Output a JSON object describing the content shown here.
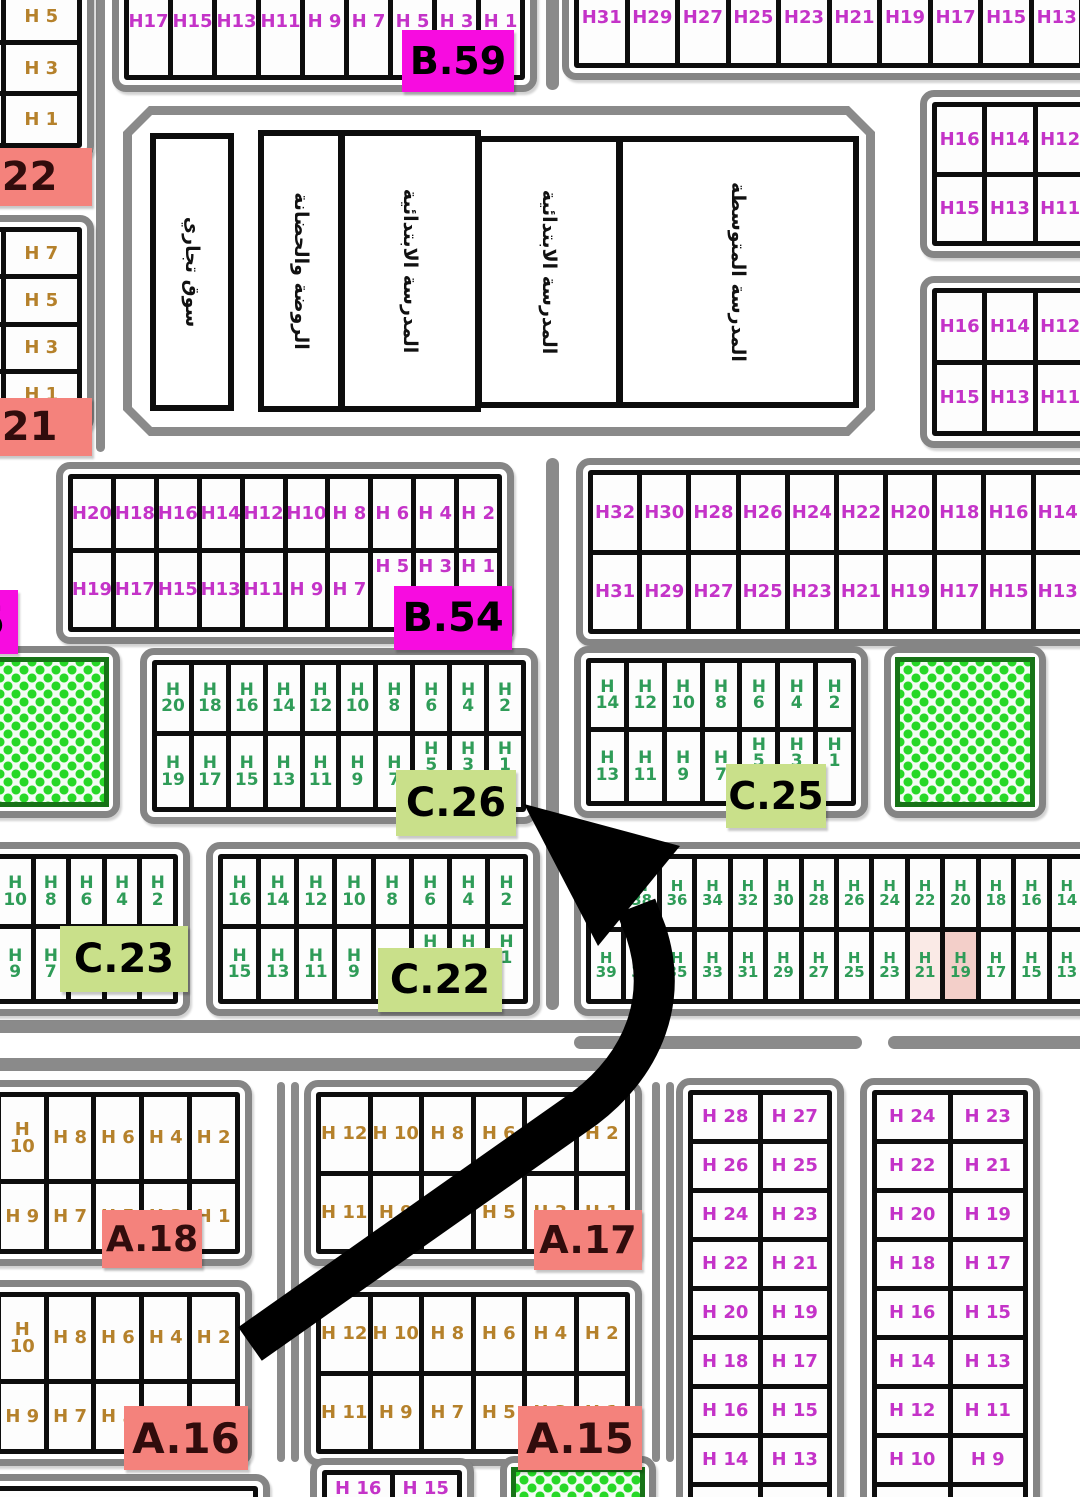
{
  "colors": {
    "canvas_bg": "#ffffff",
    "road": "#8a8a8a",
    "block_border": "#858585",
    "cell_line": "#0d0d0d",
    "cell_bg": "#fdfdfd",
    "magenta_text": "#c433c8",
    "brown_text": "#b5812b",
    "green_text": "#2f9c58",
    "magenta_label_bg": "#f70ce0",
    "salmon_label_bg": "#f4827c",
    "lime_label_bg": "#c9e08a",
    "salmon_label_text": "#310c0c",
    "park_dot": "#27d827",
    "park_border": "#177317",
    "highlight_strong": "#f3cfc9",
    "highlight_soft": "#faeae6",
    "arrow": "#000000"
  },
  "roads": [
    {
      "x": 96,
      "y": -10,
      "w": 9,
      "h": 462
    },
    {
      "x": 546,
      "y": -12,
      "w": 13,
      "h": 102
    },
    {
      "x": 546,
      "y": 458,
      "w": 13,
      "h": 552
    },
    {
      "x": -20,
      "y": 1020,
      "w": 655,
      "h": 13
    },
    {
      "x": -20,
      "y": 1058,
      "w": 655,
      "h": 13
    },
    {
      "x": 574,
      "y": 1036,
      "w": 288,
      "h": 13
    },
    {
      "x": 888,
      "y": 1036,
      "w": 202,
      "h": 13
    },
    {
      "x": 277,
      "y": 1082,
      "w": 8,
      "h": 380
    },
    {
      "x": 291,
      "y": 1082,
      "w": 8,
      "h": 380
    },
    {
      "x": 652,
      "y": 1082,
      "w": 8,
      "h": 380
    },
    {
      "x": 666,
      "y": 1082,
      "w": 8,
      "h": 380
    }
  ],
  "school": {
    "outer": {
      "x": 123,
      "y": 106,
      "w": 752,
      "h": 330
    },
    "rooms": [
      {
        "x": 150,
        "y": 133,
        "w": 84,
        "h": 278,
        "text": "سوق تجاري"
      },
      {
        "x": 258,
        "y": 130,
        "w": 86,
        "h": 282,
        "text": "الروضة والحضانة"
      },
      {
        "x": 339,
        "y": 130,
        "w": 142,
        "h": 282,
        "text": "المدرسة الابتدائية"
      },
      {
        "x": 476,
        "y": 136,
        "w": 146,
        "h": 272,
        "text": "المدرسة الابتدائية"
      },
      {
        "x": 617,
        "y": 136,
        "w": 242,
        "h": 272,
        "text": "المدرسة المتوسطة"
      }
    ]
  },
  "blocks": [
    {
      "id": "strip-b22",
      "x": -88,
      "y": -58,
      "w": 182,
      "h": 218,
      "cols": 2,
      "fs": 18,
      "tc": "brown",
      "rows": [
        [
          "",
          ""
        ],
        [
          "",
          "H 5"
        ],
        [
          "",
          "H 3"
        ],
        [
          "",
          "H 1"
        ]
      ]
    },
    {
      "id": "strip-b21",
      "x": -88,
      "y": 215,
      "w": 182,
      "h": 218,
      "cols": 2,
      "fs": 18,
      "tc": "brown",
      "rows": [
        [
          "",
          "H 7"
        ],
        [
          "",
          "H 5"
        ],
        [
          "",
          "H 3"
        ],
        [
          "",
          "H 1"
        ]
      ]
    },
    {
      "id": "row-b59",
      "x": 112,
      "y": -48,
      "w": 425,
      "h": 140,
      "cols": 9,
      "fs": 18,
      "tc": "magenta",
      "rows": [
        [
          "H17",
          "H15",
          "H13",
          "H11",
          "H 9",
          "H 7",
          "H 5",
          "H 3",
          "H 1"
        ]
      ]
    },
    {
      "id": "row-top-right",
      "x": 562,
      "y": -45,
      "w": 585,
      "h": 125,
      "cols": 11,
      "fs": 18,
      "tc": "magenta",
      "rows": [
        [
          "H31",
          "H29",
          "H27",
          "H25",
          "H23",
          "H21",
          "H19",
          "H17",
          "H15",
          "H13",
          "H11"
        ]
      ]
    },
    {
      "id": "grid-ne-1",
      "x": 920,
      "y": 90,
      "w": 230,
      "h": 168,
      "cols": 4,
      "fs": 18,
      "tc": "magenta",
      "rows": [
        [
          "H16",
          "H14",
          "H12",
          ""
        ],
        [
          "H15",
          "H13",
          "H11",
          ""
        ]
      ]
    },
    {
      "id": "grid-ne-2",
      "x": 920,
      "y": 276,
      "w": 230,
      "h": 172,
      "cols": 4,
      "fs": 18,
      "tc": "magenta",
      "rows": [
        [
          "H16",
          "H14",
          "H12",
          ""
        ],
        [
          "H15",
          "H13",
          "H11",
          ""
        ]
      ]
    },
    {
      "id": "block-b54",
      "x": 56,
      "y": 462,
      "w": 458,
      "h": 182,
      "cols": 10,
      "fs": 18,
      "tc": "magenta",
      "rows": [
        [
          "H20",
          "H18",
          "H16",
          "H14",
          "H12",
          "H10",
          "H 8",
          "H 6",
          "H 4",
          "H 2"
        ],
        [
          "H19",
          "H17",
          "H15",
          "H13",
          "H11",
          "H 9",
          "H 7",
          "^H 5",
          "^H 3",
          "^H 1"
        ]
      ]
    },
    {
      "id": "block-mid-right",
      "x": 576,
      "y": 458,
      "w": 570,
      "h": 188,
      "cols": 11,
      "fs": 18,
      "tc": "magenta",
      "rows": [
        [
          "H32",
          "H30",
          "H28",
          "H26",
          "H24",
          "H22",
          "H20",
          "H18",
          "H16",
          "H14",
          "H12"
        ],
        [
          "H31",
          "H29",
          "H27",
          "H25",
          "H23",
          "H21",
          "H19",
          "H17",
          "H15",
          "H13",
          "H11"
        ]
      ]
    },
    {
      "id": "block-c26",
      "x": 140,
      "y": 648,
      "w": 398,
      "h": 176,
      "cols": 10,
      "fs": 17,
      "tc": "green",
      "rows": [
        [
          "H|20",
          "H|18",
          "H|16",
          "H|14",
          "H|12",
          "H|10",
          "H|8",
          "H|6",
          "H|4",
          "H|2"
        ],
        [
          "H|19",
          "H|17",
          "H|15",
          "H|13",
          "H|11",
          "H|9",
          "H|7",
          "^H|5",
          "^H|3",
          "^H|1"
        ]
      ]
    },
    {
      "id": "block-c25",
      "x": 574,
      "y": 646,
      "w": 294,
      "h": 172,
      "cols": 7,
      "fs": 17,
      "tc": "green",
      "rows": [
        [
          "H|14",
          "H|12",
          "H|10",
          "H|8",
          "H|6",
          "H|4",
          "H|2"
        ],
        [
          "H|13",
          "H|11",
          "H|9",
          "H|7",
          "^H|5",
          "^H|3",
          "^H|1"
        ]
      ]
    },
    {
      "id": "block-c23",
      "x": -124,
      "y": 842,
      "w": 314,
      "h": 174,
      "cols": 8,
      "fs": 17,
      "tc": "green",
      "rows": [
        [
          "",
          "",
          "",
          "H|10",
          "H|8",
          "H|6",
          "H|4",
          "H|2"
        ],
        [
          "",
          "",
          "",
          "H|9",
          "H|7",
          "^H|5",
          "^H|3",
          "^H|1"
        ]
      ]
    },
    {
      "id": "block-c22",
      "x": 206,
      "y": 842,
      "w": 334,
      "h": 174,
      "cols": 8,
      "fs": 17,
      "tc": "green",
      "rows": [
        [
          "H|16",
          "H|14",
          "H|12",
          "H|10",
          "H|8",
          "H|6",
          "H|4",
          "H|2"
        ],
        [
          "H|15",
          "H|13",
          "H|11",
          "H|9",
          "H|7",
          "^H|5",
          "^H|3",
          "^H|1"
        ]
      ]
    },
    {
      "id": "block-c-east",
      "x": 574,
      "y": 842,
      "w": 525,
      "h": 174,
      "cols": 14,
      "fs": 15,
      "tc": "green",
      "rows": [
        [
          "H|40",
          "H|38",
          "H|36",
          "H|34",
          "H|32",
          "H|30",
          "H|28",
          "H|26",
          "H|24",
          "H|22",
          "H|20",
          "H|18",
          "H|16",
          "H|14"
        ],
        [
          "H|39",
          "H|37",
          "H|35",
          "H|33",
          "H|31",
          "H|29",
          "H|27",
          "H|25",
          "H|23",
          "~H|21",
          "!H|19",
          "H|17",
          "H|15",
          "H|13"
        ]
      ]
    },
    {
      "id": "block-a18",
      "x": -64,
      "y": 1080,
      "w": 316,
      "h": 186,
      "cols": 6,
      "fs": 18,
      "tc": "brown",
      "rows": [
        [
          "",
          "H 10",
          "H 8",
          "H 6",
          "H 4",
          "H 2"
        ],
        [
          "",
          "H 9",
          "H 7",
          "H 5",
          "H 3",
          "H 1"
        ]
      ]
    },
    {
      "id": "block-a17",
      "x": 304,
      "y": 1080,
      "w": 338,
      "h": 186,
      "cols": 6,
      "fs": 18,
      "tc": "brown",
      "rows": [
        [
          "H 12",
          "H 10",
          "H 8",
          "H 6",
          "H 4",
          "H 2"
        ],
        [
          "H 11",
          "H 9",
          "H 7",
          "H 5",
          "H 3",
          "H 1"
        ]
      ]
    },
    {
      "id": "block-a16",
      "x": -64,
      "y": 1280,
      "w": 316,
      "h": 186,
      "cols": 6,
      "fs": 18,
      "tc": "brown",
      "rows": [
        [
          "",
          "H 10",
          "H 8",
          "H 6",
          "H 4",
          "H 2"
        ],
        [
          "",
          "H 9",
          "H 7",
          "H 5",
          "H 3",
          "H 1"
        ]
      ]
    },
    {
      "id": "block-a15",
      "x": 304,
      "y": 1280,
      "w": 338,
      "h": 186,
      "cols": 6,
      "fs": 18,
      "tc": "brown",
      "rows": [
        [
          "H 12",
          "H 10",
          "H 8",
          "H 6",
          "H 4",
          "H 2"
        ],
        [
          "H 11",
          "H 9",
          "H 7",
          "H 5",
          "H 3",
          "H 1"
        ]
      ]
    },
    {
      "id": "grid-se-1",
      "x": 676,
      "y": 1078,
      "w": 168,
      "h": 470,
      "cols": 2,
      "fs": 18,
      "tc": "magenta",
      "rows": [
        [
          "H 28",
          "H 27"
        ],
        [
          "H 26",
          "H 25"
        ],
        [
          "H 24",
          "H 23"
        ],
        [
          "H 22",
          "H 21"
        ],
        [
          "H 20",
          "H 19"
        ],
        [
          "H 18",
          "H 17"
        ],
        [
          "H 16",
          "H 15"
        ],
        [
          "H 14",
          "H 13"
        ],
        [
          "H 12",
          "H 11"
        ]
      ]
    },
    {
      "id": "grid-se-2",
      "x": 860,
      "y": 1078,
      "w": 180,
      "h": 470,
      "cols": 2,
      "fs": 18,
      "tc": "magenta",
      "rows": [
        [
          "H 24",
          "H 23"
        ],
        [
          "H 22",
          "H 21"
        ],
        [
          "H 20",
          "H 19"
        ],
        [
          "H 18",
          "H 17"
        ],
        [
          "H 16",
          "H 15"
        ],
        [
          "H 14",
          "H 13"
        ],
        [
          "H 12",
          "H 11"
        ],
        [
          "H 10",
          "H 9"
        ],
        [
          "H 8",
          "H 7"
        ]
      ]
    },
    {
      "id": "block-h16-h15",
      "x": 310,
      "y": 1458,
      "w": 164,
      "h": 84,
      "cols": 2,
      "fs": 18,
      "tc": "magenta",
      "align": "top",
      "rows": [
        [
          "H 16",
          "H 15"
        ]
      ]
    },
    {
      "id": "frame-bottom-left",
      "type": "frame",
      "x": -30,
      "y": 1474,
      "w": 300,
      "h": 90,
      "cols": 1,
      "fs": 14,
      "tc": "brown",
      "rows": [
        [
          ""
        ]
      ]
    },
    {
      "id": "park-west",
      "type": "park",
      "x": -64,
      "y": 646,
      "w": 184,
      "h": 172
    },
    {
      "id": "park-east",
      "type": "park",
      "x": 884,
      "y": 646,
      "w": 162,
      "h": 172
    },
    {
      "id": "park-south",
      "type": "park",
      "x": 500,
      "y": 1456,
      "w": 156,
      "h": 90
    }
  ],
  "labels": [
    {
      "text": ".22",
      "style": "salmon",
      "x": -48,
      "y": 148,
      "w": 140,
      "h": 58,
      "fs": 40
    },
    {
      "text": ".21",
      "style": "salmon",
      "x": -48,
      "y": 398,
      "w": 140,
      "h": 58,
      "fs": 40
    },
    {
      "text": "B.59",
      "style": "magenta",
      "x": 402,
      "y": 30,
      "w": 112,
      "h": 62,
      "fs": 38
    },
    {
      "text": "B.54",
      "style": "magenta",
      "x": 394,
      "y": 586,
      "w": 118,
      "h": 64,
      "fs": 40
    },
    {
      "text": "5",
      "style": "magenta",
      "x": -36,
      "y": 590,
      "w": 54,
      "h": 64,
      "fs": 40
    },
    {
      "text": "C.26",
      "style": "lime",
      "x": 396,
      "y": 770,
      "w": 120,
      "h": 66,
      "fs": 40
    },
    {
      "text": "C.25",
      "style": "lime",
      "x": 726,
      "y": 764,
      "w": 100,
      "h": 64,
      "fs": 38
    },
    {
      "text": "C.23",
      "style": "lime",
      "x": 60,
      "y": 926,
      "w": 128,
      "h": 66,
      "fs": 40
    },
    {
      "text": "C.22",
      "style": "lime",
      "x": 378,
      "y": 948,
      "w": 124,
      "h": 64,
      "fs": 40
    },
    {
      "text": "A.18",
      "style": "salmon",
      "x": 102,
      "y": 1210,
      "w": 100,
      "h": 58,
      "fs": 36
    },
    {
      "text": "A.17",
      "style": "salmon",
      "x": 534,
      "y": 1210,
      "w": 108,
      "h": 60,
      "fs": 38
    },
    {
      "text": "A.16",
      "style": "salmon",
      "x": 124,
      "y": 1406,
      "w": 124,
      "h": 64,
      "fs": 42
    },
    {
      "text": "A.15",
      "style": "salmon",
      "x": 518,
      "y": 1406,
      "w": 124,
      "h": 64,
      "fs": 42
    }
  ]
}
